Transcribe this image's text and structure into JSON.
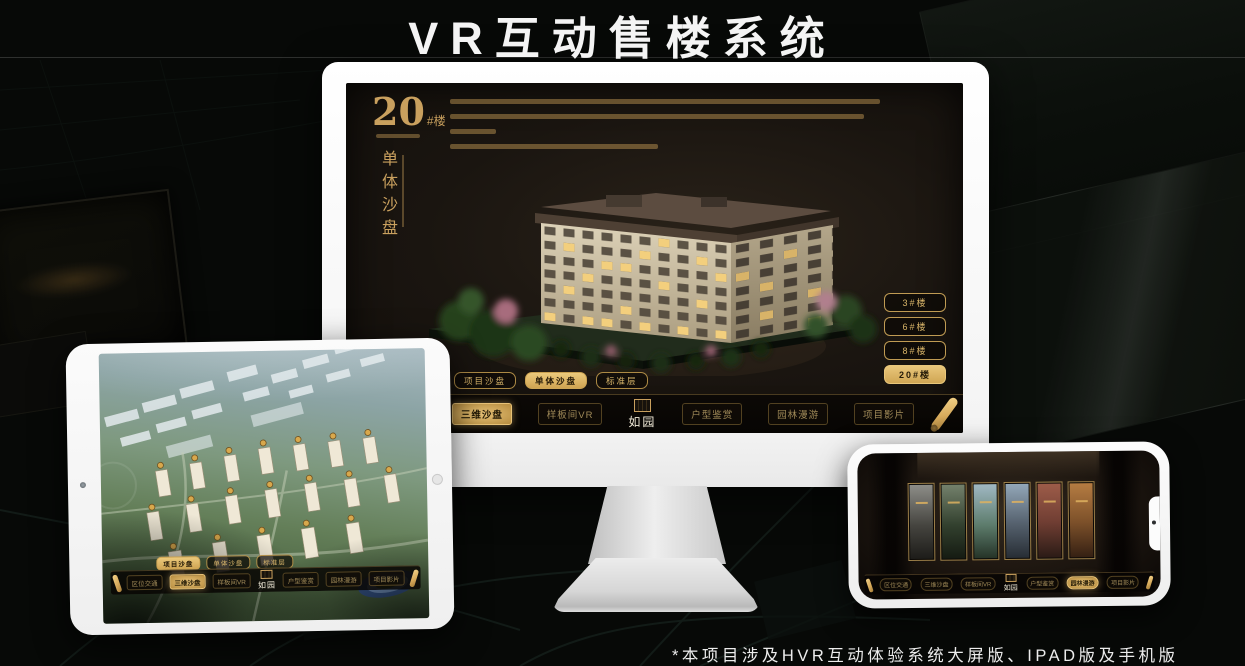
{
  "page": {
    "title": "VR互动售楼系统",
    "footnote": "*本项目涉及HVR互动体验系统大屏版、IPAD版及手机版"
  },
  "colors": {
    "gold": "#c9a05e",
    "gold_bright": "#e7c277",
    "screen_bg": "#1a1510",
    "title_white": "#f4f4f4"
  },
  "nav": {
    "logo": "如园",
    "items": [
      {
        "label": "区位交通"
      },
      {
        "label": "三维沙盘"
      },
      {
        "label": "样板间VR"
      },
      {
        "label": "户型鉴赏"
      },
      {
        "label": "园林漫游"
      },
      {
        "label": "项目影片"
      }
    ]
  },
  "sub_tabs": [
    {
      "label": "项目沙盘"
    },
    {
      "label": "单体沙盘"
    },
    {
      "label": "标准层"
    }
  ],
  "monitor": {
    "building_no": "20",
    "building_unit": "#楼",
    "subtitle": "单体沙盘",
    "floor_buttons": [
      {
        "label": "3#楼"
      },
      {
        "label": "6#楼"
      },
      {
        "label": "8#楼"
      },
      {
        "label": "20#楼"
      }
    ]
  }
}
